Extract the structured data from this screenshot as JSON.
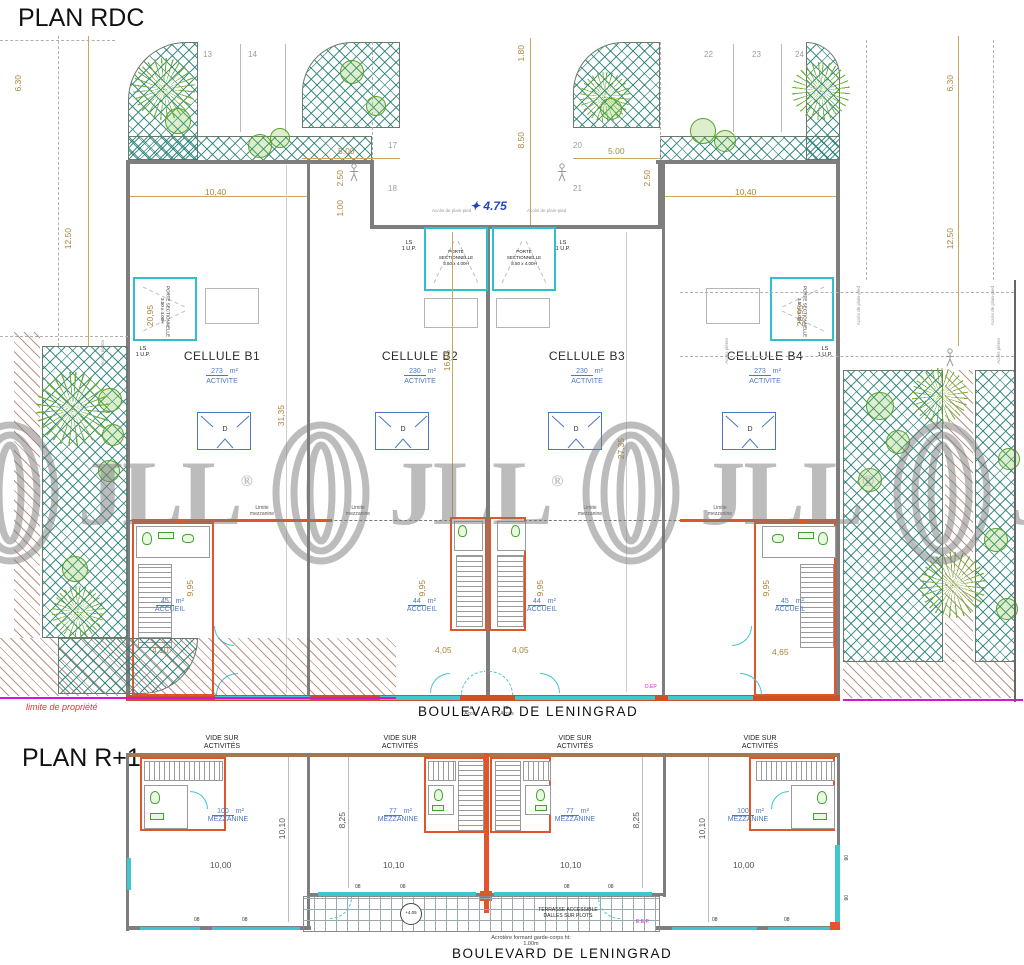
{
  "watermark": {
    "brand": "JLL",
    "reg": "®"
  },
  "rdc": {
    "title": "PLAN RDC",
    "street": "BOULEVARD DE LENINGRAD",
    "property_label": "limite de propriété",
    "level_star": "✦",
    "level": "4.75",
    "dep": "D.EP",
    "acces": "Accès",
    "acces_plain_pied": "Accès de plain-pied",
    "acces_pieton": "Accès piéton",
    "porte": {
      "l1": "PORTE",
      "l2": "SECTIONNELLE",
      "size": "3.50 x 4.00H"
    },
    "ls": "LS",
    "up": "1 U.P.",
    "limite_mezz": {
      "l1": "Limite",
      "l2": "mezzanine"
    },
    "cells": [
      {
        "name": "CELLULE B1",
        "area": "273",
        "unit": "m²",
        "use": "ACTIVITE",
        "dock": "D"
      },
      {
        "name": "CELLULE B2",
        "area": "230",
        "unit": "m²",
        "use": "ACTIVITE",
        "dock": "D"
      },
      {
        "name": "CELLULE B3",
        "area": "230",
        "unit": "m²",
        "use": "ACTIVITE",
        "dock": "D"
      },
      {
        "name": "CELLULE B4",
        "area": "273",
        "unit": "m²",
        "use": "ACTIVITE",
        "dock": "D"
      }
    ],
    "accueils": [
      {
        "area": "45",
        "unit": "m²",
        "label": "ACCUEIL"
      },
      {
        "area": "44",
        "unit": "m²",
        "label": "ACCUEIL"
      },
      {
        "area": "44",
        "unit": "m²",
        "label": "ACCUEIL"
      },
      {
        "area": "45",
        "unit": "m²",
        "label": "ACCUEIL"
      }
    ],
    "parking": [
      "13",
      "14",
      "17",
      "18",
      "20",
      "21",
      "22",
      "23",
      "24"
    ],
    "dims": {
      "d630": "6.30",
      "d1250": "12.50",
      "d1040": "10,40",
      "d500": "5.00",
      "d250": "2.50",
      "d100": "1.00",
      "d180": "1.80",
      "d850": "8.50",
      "d2095": "20,95",
      "d1695": "16,95",
      "d3135": "31,35",
      "d2735": "27,35",
      "d995": "9,95",
      "d410": "4,10",
      "d405": "4,05",
      "d465": "4,65"
    }
  },
  "r1": {
    "title": "PLAN R+1",
    "street": "BOULEVARD DE LENINGRAD",
    "vide": {
      "l1": "VIDE SUR",
      "l2": "ACTIVITÉS"
    },
    "mezzanines": [
      {
        "area": "100",
        "unit": "m²",
        "label": "MEZZANINE"
      },
      {
        "area": "77",
        "unit": "m²",
        "label": "MEZZANINE"
      },
      {
        "area": "77",
        "unit": "m²",
        "label": "MEZZANINE"
      },
      {
        "area": "100",
        "unit": "m²",
        "label": "MEZZANINE"
      }
    ],
    "terrasse": {
      "l1": "TERRASSE ACCESSIBLE",
      "l2": "DALLES SUR PLOTS"
    },
    "acrotere": {
      "l1": "Acrotère formant garde-corps ht:",
      "l2": "1.00m"
    },
    "level": "+4.05",
    "eep": "E.E.P.",
    "win": "08",
    "dims": {
      "d1010": "10,10",
      "d825": "8,25",
      "d1000": "10,00"
    }
  }
}
